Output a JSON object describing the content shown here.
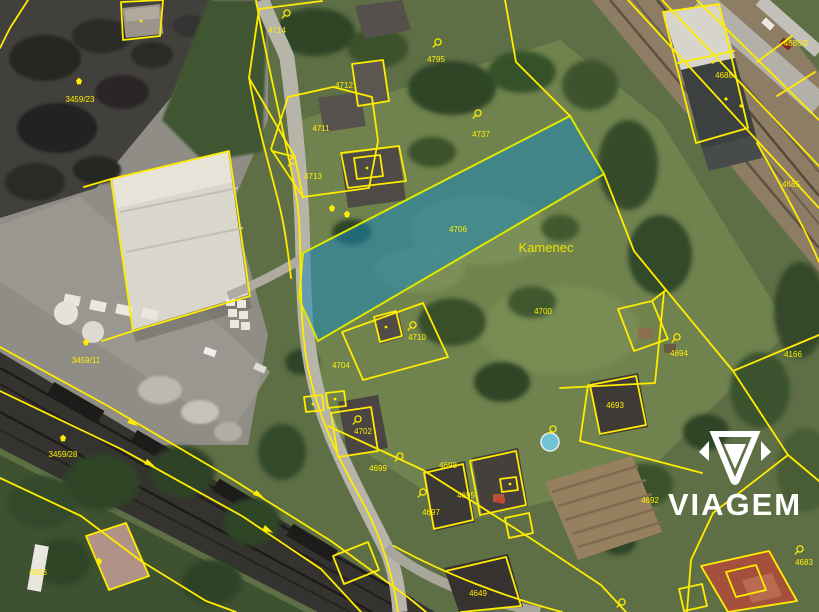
{
  "map": {
    "area_label": "Kamenec",
    "highlighted_parcel": "4706",
    "colors": {
      "cadastre_line": "#ffec00",
      "parcel_text": "#ffef00",
      "highlight_fill": "#1d86b8",
      "highlight_opacity": "0.55",
      "watermark": "#ffffff"
    },
    "parcel_labels": [
      {
        "label": "4714"
      },
      {
        "label": "4795"
      },
      {
        "label": "4712"
      },
      {
        "label": "4711"
      },
      {
        "label": "4713"
      },
      {
        "label": "4737"
      },
      {
        "label": "4706"
      },
      {
        "label": "4700"
      },
      {
        "label": "4710"
      },
      {
        "label": "4704"
      },
      {
        "label": "4702"
      },
      {
        "label": "4699"
      },
      {
        "label": "4698"
      },
      {
        "label": "4695"
      },
      {
        "label": "4697"
      },
      {
        "label": "4693"
      },
      {
        "label": "4694"
      },
      {
        "label": "4692"
      },
      {
        "label": "4166"
      },
      {
        "label": "4686/2"
      },
      {
        "label": "4688"
      },
      {
        "label": "4685"
      },
      {
        "label": "4683"
      },
      {
        "label": "3459/23"
      },
      {
        "label": "3459/11"
      },
      {
        "label": "3459/28"
      },
      {
        "label": "4626"
      },
      {
        "label": "4649"
      }
    ]
  },
  "watermark": {
    "brand": "VIAGEM"
  }
}
